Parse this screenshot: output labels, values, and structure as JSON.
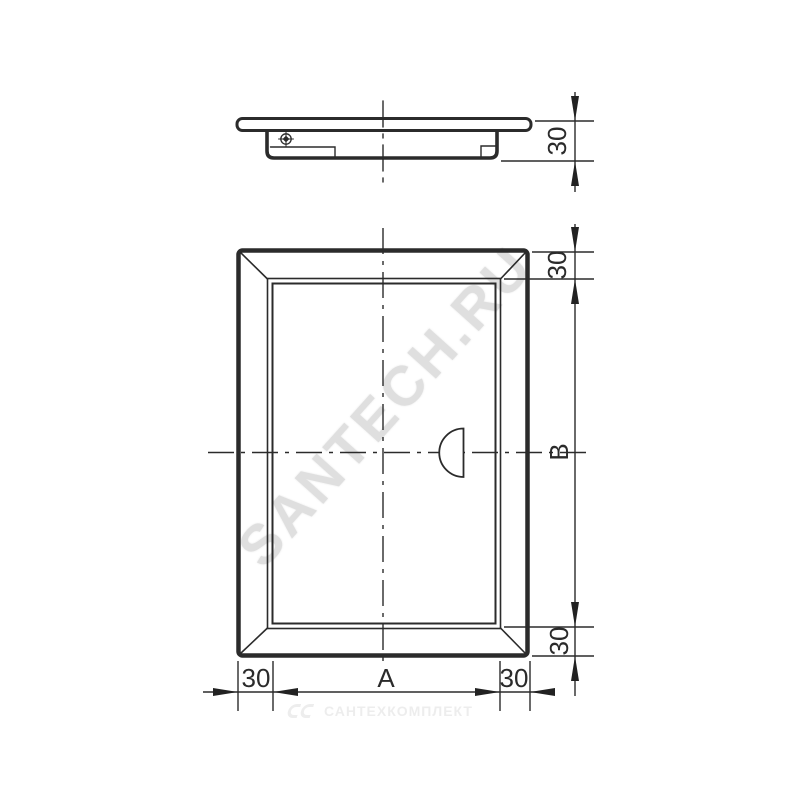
{
  "page": {
    "background": "#ffffff"
  },
  "drawing": {
    "line_color": "#2b2b2b",
    "dimensions": {
      "side_thickness": "30",
      "top_frame": "30",
      "opening_height": "B",
      "bottom_frame": "30",
      "left_frame": "30",
      "opening_width": "A",
      "right_frame": "30"
    }
  },
  "watermarks": {
    "diagonal_text": "SANTECH.RU",
    "diagonal_color": "#d8d8d8",
    "footer_text": "САНТЕХКОМПЛЕКТ",
    "footer_color": "#ececec"
  }
}
